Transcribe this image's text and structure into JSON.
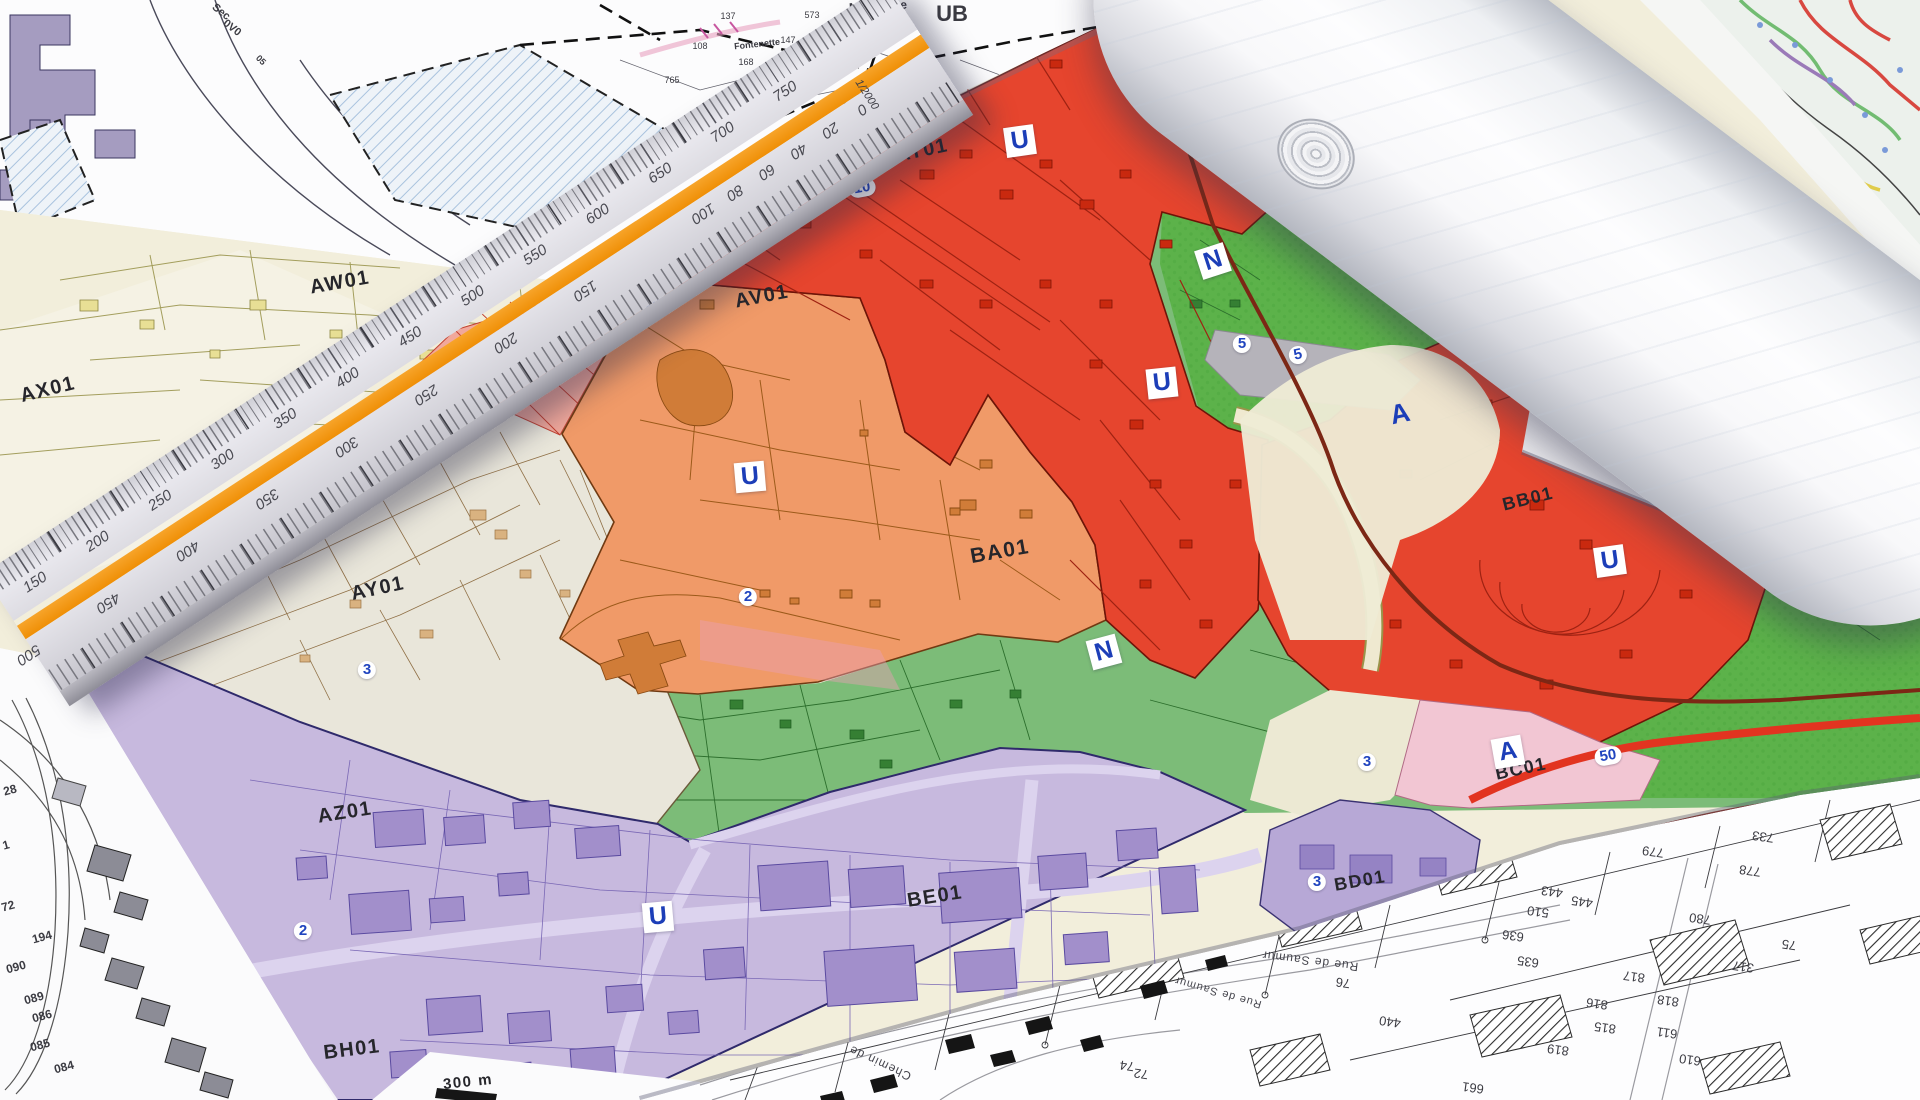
{
  "map": {
    "zone_labels": [
      {
        "text": "AW01",
        "x": 340,
        "y": 283,
        "rot": -10,
        "size": 20
      },
      {
        "text": "AX01",
        "x": 48,
        "y": 390,
        "rot": -14,
        "size": 20
      },
      {
        "text": "AY01",
        "x": 378,
        "y": 589,
        "rot": -12,
        "size": 20
      },
      {
        "text": "AV01",
        "x": 762,
        "y": 297,
        "rot": -11,
        "size": 20
      },
      {
        "text": "AT01",
        "x": 922,
        "y": 151,
        "rot": -12,
        "size": 20
      },
      {
        "text": "BA01",
        "x": 1000,
        "y": 552,
        "rot": -10,
        "size": 21
      },
      {
        "text": "AZ01",
        "x": 345,
        "y": 813,
        "rot": -9,
        "size": 20
      },
      {
        "text": "BH01",
        "x": 352,
        "y": 1050,
        "rot": -7,
        "size": 20
      },
      {
        "text": "BE01",
        "x": 935,
        "y": 897,
        "rot": -9,
        "size": 20
      },
      {
        "text": "BD01",
        "x": 1360,
        "y": 881,
        "rot": -10,
        "size": 18
      },
      {
        "text": "BC01",
        "x": 1521,
        "y": 769,
        "rot": -12,
        "size": 18
      },
      {
        "text": "BB01",
        "x": 1528,
        "y": 499,
        "rot": -14,
        "size": 18
      }
    ],
    "letter_badges": [
      {
        "text": "U",
        "x": 1020,
        "y": 141,
        "rot": -8
      },
      {
        "text": "U",
        "x": 1162,
        "y": 383,
        "rot": -6
      },
      {
        "text": "U",
        "x": 750,
        "y": 477,
        "rot": -5
      },
      {
        "text": "U",
        "x": 658,
        "y": 917,
        "rot": -5
      },
      {
        "text": "U",
        "x": 1610,
        "y": 561,
        "rot": -8
      },
      {
        "text": "N",
        "x": 1213,
        "y": 261,
        "rot": -18
      },
      {
        "text": "N",
        "x": 1104,
        "y": 652,
        "rot": -15
      },
      {
        "text": "A",
        "x": 1508,
        "y": 752,
        "rot": -10
      }
    ],
    "plain_letters": [
      {
        "text": "A",
        "x": 1400,
        "y": 414,
        "rot": -12
      }
    ],
    "number_badges": [
      {
        "text": "10",
        "x": 862,
        "y": 188,
        "rot": -10
      },
      {
        "text": "20",
        "x": 790,
        "y": 217,
        "rot": -10
      },
      {
        "text": "16",
        "x": 652,
        "y": 302,
        "rot": -12
      },
      {
        "text": "2",
        "x": 748,
        "y": 597,
        "rot": 0
      },
      {
        "text": "3",
        "x": 367,
        "y": 670,
        "rot": 0
      },
      {
        "text": "2",
        "x": 303,
        "y": 931,
        "rot": 0
      },
      {
        "text": "5",
        "x": 1242,
        "y": 344,
        "rot": 0
      },
      {
        "text": "5",
        "x": 1298,
        "y": 355,
        "rot": -12
      },
      {
        "text": "50",
        "x": 1608,
        "y": 756,
        "rot": -10
      },
      {
        "text": "3",
        "x": 1367,
        "y": 762,
        "rot": 0
      },
      {
        "text": "3",
        "x": 1317,
        "y": 882,
        "rot": 0
      }
    ],
    "scale_text": {
      "text": "300 m",
      "x": 468,
      "y": 1082,
      "rot": -6
    }
  },
  "ruler": {
    "top_scale": [
      "150",
      "200",
      "250",
      "300",
      "350",
      "400",
      "450",
      "500",
      "550",
      "600",
      "650",
      "700",
      "750"
    ],
    "bottom_scale": [
      "500",
      "450",
      "400",
      "350",
      "300",
      "250",
      "200",
      "150",
      "100",
      "80",
      "60",
      "40",
      "20",
      "0"
    ],
    "ratio_label": "1/2000",
    "stripe_color": "#ef8f06"
  },
  "sheets": {
    "top_left": {
      "labels": [
        {
          "text": "Sec",
          "x": 221,
          "y": 12,
          "rot": 38,
          "size": 11
        },
        {
          "text": "0V0",
          "x": 232,
          "y": 28,
          "rot": 38,
          "size": 11
        },
        {
          "text": "Madelaine",
          "x": 878,
          "y": 6,
          "rot": -3,
          "size": 12
        },
        {
          "text": "UB",
          "x": 952,
          "y": 14,
          "rot": 0,
          "size": 22
        },
        {
          "text": "Fontenette",
          "x": 757,
          "y": 44,
          "rot": -6,
          "size": 9
        },
        {
          "text": "05",
          "x": 261,
          "y": 60,
          "rot": 45,
          "size": 9
        }
      ],
      "parcel_numbers": [
        {
          "text": "147",
          "x": 788,
          "y": 40
        },
        {
          "text": "108",
          "x": 700,
          "y": 46
        },
        {
          "text": "137",
          "x": 728,
          "y": 16
        },
        {
          "text": "168",
          "x": 746,
          "y": 62
        },
        {
          "text": "573",
          "x": 812,
          "y": 15
        },
        {
          "text": "116",
          "x": 842,
          "y": 66
        },
        {
          "text": "765",
          "x": 672,
          "y": 80
        }
      ]
    },
    "left": {
      "parcel_numbers": [
        {
          "text": "28",
          "x": 10,
          "y": 790
        },
        {
          "text": "1",
          "x": 6,
          "y": 845
        },
        {
          "text": "72",
          "x": 8,
          "y": 906
        },
        {
          "text": "194",
          "x": 42,
          "y": 937
        },
        {
          "text": "090",
          "x": 16,
          "y": 967
        },
        {
          "text": "089",
          "x": 34,
          "y": 998
        },
        {
          "text": "086",
          "x": 42,
          "y": 1016
        },
        {
          "text": "085",
          "x": 40,
          "y": 1045
        },
        {
          "text": "084",
          "x": 64,
          "y": 1067
        }
      ]
    },
    "bottom_right": {
      "street_names": [
        {
          "text": "Rue de Saumur",
          "x": 1310,
          "y": 961,
          "rot": 187,
          "size": 12
        },
        {
          "text": "Rue de Saumur",
          "x": 1218,
          "y": 992,
          "rot": 196,
          "size": 11
        },
        {
          "text": "Chemin de",
          "x": 880,
          "y": 1063,
          "rot": 205,
          "size": 12
        }
      ],
      "parcel_numbers": [
        {
          "text": "76",
          "x": 1343,
          "y": 983
        },
        {
          "text": "440",
          "x": 1390,
          "y": 1022
        },
        {
          "text": "819",
          "x": 1558,
          "y": 1050
        },
        {
          "text": "815",
          "x": 1605,
          "y": 1028
        },
        {
          "text": "816",
          "x": 1597,
          "y": 1004
        },
        {
          "text": "817",
          "x": 1634,
          "y": 977
        },
        {
          "text": "818",
          "x": 1668,
          "y": 1001
        },
        {
          "text": "611",
          "x": 1667,
          "y": 1033
        },
        {
          "text": "610",
          "x": 1690,
          "y": 1060
        },
        {
          "text": "661",
          "x": 1473,
          "y": 1088
        },
        {
          "text": "635",
          "x": 1528,
          "y": 962
        },
        {
          "text": "636",
          "x": 1513,
          "y": 936
        },
        {
          "text": "510",
          "x": 1538,
          "y": 912
        },
        {
          "text": "443",
          "x": 1552,
          "y": 892
        },
        {
          "text": "445",
          "x": 1582,
          "y": 902
        },
        {
          "text": "317",
          "x": 1743,
          "y": 967
        },
        {
          "text": "780",
          "x": 1700,
          "y": 919
        },
        {
          "text": "779",
          "x": 1653,
          "y": 852
        },
        {
          "text": "778",
          "x": 1750,
          "y": 871
        },
        {
          "text": "75",
          "x": 1789,
          "y": 945
        },
        {
          "text": "74",
          "x": 1127,
          "y": 1066
        },
        {
          "text": "72",
          "x": 1141,
          "y": 1074
        },
        {
          "text": "733",
          "x": 1763,
          "y": 837
        }
      ]
    }
  },
  "colors": {
    "zone_red": "#e6452e",
    "zone_orange": "#f09a68",
    "zone_green": "#7cbc78",
    "zone_green_bright": "#5cb24a",
    "zone_purple": "#c7b9de",
    "zone_pink": "#f2c6d3",
    "zone_cream": "#f2eedb",
    "zone_beige": "#e9e6da",
    "zone_salmon": "#f1a89b",
    "badge_blue": "#1c3eb8",
    "ruler_stripe": "#ef8f06",
    "route_maroon": "#7c2715",
    "road_red": "#e23420"
  }
}
